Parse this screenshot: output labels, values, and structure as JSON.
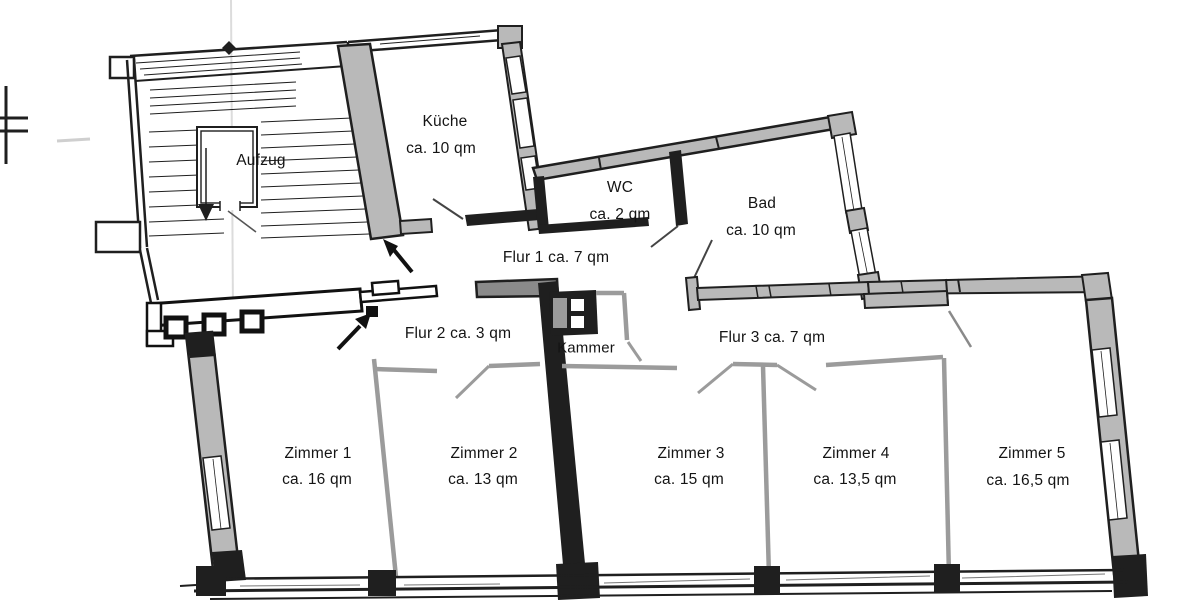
{
  "rooms": {
    "aufzug": {
      "name": "Aufzug"
    },
    "kueche": {
      "name": "Küche",
      "area": "ca. 10 qm"
    },
    "wc": {
      "name": "WC",
      "area": "ca. 2 qm"
    },
    "bad": {
      "name": "Bad",
      "area": "ca. 10 qm"
    },
    "flur1": {
      "name": "Flur 1 ca. 7 qm"
    },
    "flur2": {
      "name": "Flur 2 ca. 3 qm"
    },
    "kammer": {
      "name": "Kammer"
    },
    "flur3": {
      "name": "Flur 3 ca. 7 qm"
    },
    "zimmer1": {
      "name": "Zimmer 1",
      "area": "ca. 16 qm"
    },
    "zimmer2": {
      "name": "Zimmer 2",
      "area": "ca. 13 qm"
    },
    "zimmer3": {
      "name": "Zimmer 3",
      "area": "ca. 15 qm"
    },
    "zimmer4": {
      "name": "Zimmer 4",
      "area": "ca. 13,5 qm"
    },
    "zimmer5": {
      "name": "Zimmer 5",
      "area": "ca. 16,5 qm"
    }
  },
  "icons": {
    "entrance_arrow_stairwell": "arrow-up-left",
    "entrance_arrow_flur2": "arrow-up-right",
    "stair_direction_arrow": "arrow-down"
  },
  "colors": {
    "wall": "#1f1f1f",
    "wall_fill": "#b9b9b9",
    "partition": "#9b9b9b",
    "background": "#ffffff"
  }
}
